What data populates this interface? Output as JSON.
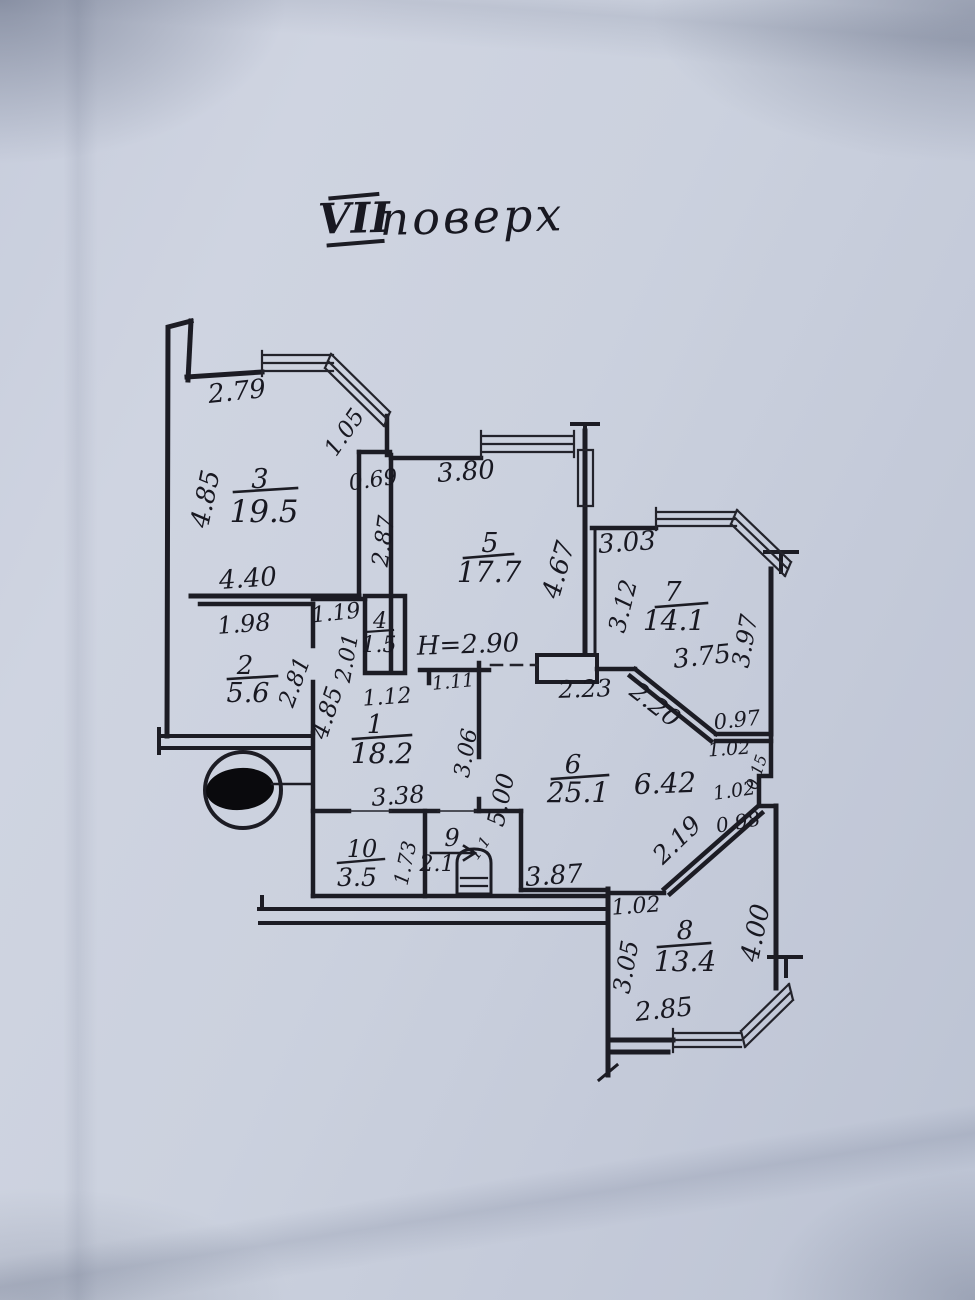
{
  "title": {
    "numeral": "VII",
    "word": "поверх"
  },
  "note_height": "H=2.90",
  "rooms": {
    "r1": {
      "number": "1",
      "area": "18.2"
    },
    "r2": {
      "number": "2",
      "area": "5.6"
    },
    "r3": {
      "number": "3",
      "area": "19.5"
    },
    "r4": {
      "number": "4",
      "area": "1.5"
    },
    "r5": {
      "number": "5",
      "area": "17.7"
    },
    "r6": {
      "number": "6",
      "area": "25.1"
    },
    "r7": {
      "number": "7",
      "area": "14.1"
    },
    "r8": {
      "number": "8",
      "area": "13.4"
    },
    "r9": {
      "number": "9",
      "area": "2.1"
    },
    "r10": {
      "number": "10",
      "area": "3.5"
    }
  },
  "dims": {
    "room3": {
      "top": "2.79",
      "left": "4.85",
      "bottom": "4.40",
      "bay": "1.05",
      "jog": "0.69",
      "right": "2.87"
    },
    "room5": {
      "top": "3.80",
      "right": "4.67",
      "bottom_left": "1.11",
      "bottom_right": "2.23"
    },
    "room7": {
      "top": "3.03",
      "left": "3.12",
      "bottom": "3.75",
      "right": "3.97",
      "diagonal": "2.20",
      "ledge": "0.97"
    },
    "niche": {
      "a": "1.02",
      "b": "0.15",
      "c": "1.02",
      "d": "0.98"
    },
    "room2": {
      "top": "1.98",
      "right": "2.81"
    },
    "room4": {
      "top": "1.19",
      "left": "2.01",
      "below": "1.12"
    },
    "room1": {
      "left": "4.85",
      "bottom": "3.38",
      "right": "3.06",
      "right2": "5.00"
    },
    "room6": {
      "width": "6.42",
      "bottom": "3.87",
      "diagonal": "2.19"
    },
    "room10": {
      "depth": "1.73"
    },
    "room9": {
      "side": "1.1"
    },
    "room8": {
      "top": "1.02",
      "left": "3.05",
      "bottom": "2.85",
      "right": "4.00"
    }
  }
}
